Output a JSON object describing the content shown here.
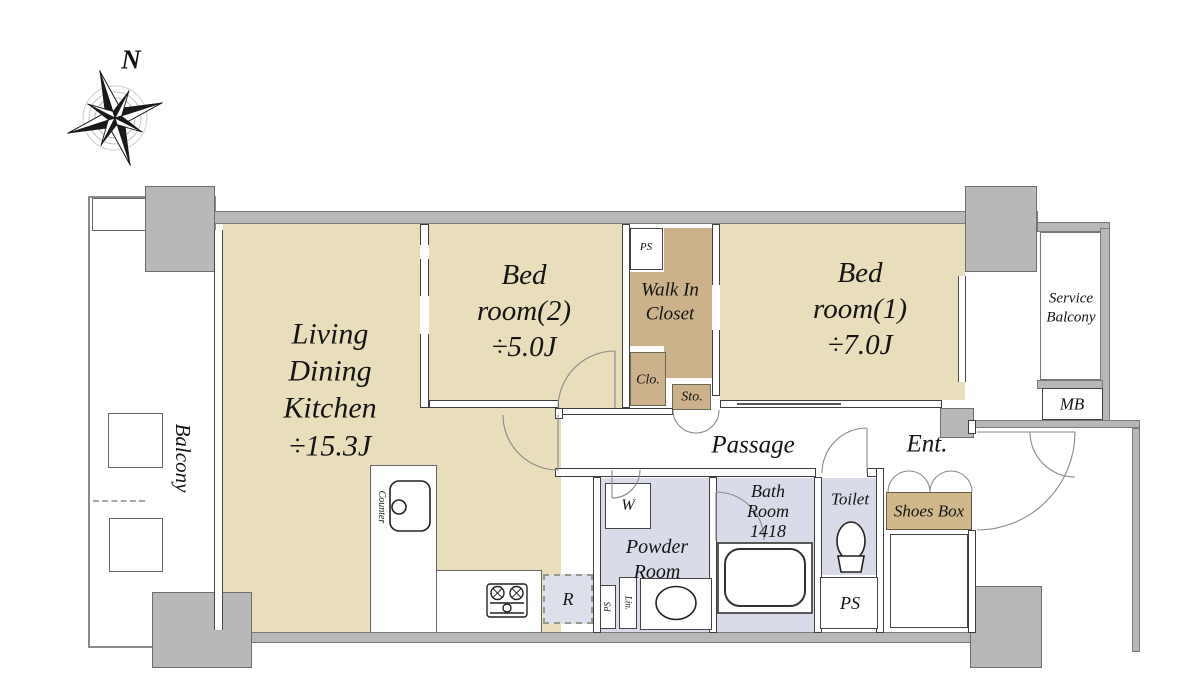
{
  "compass": {
    "north_label": "N"
  },
  "palette": {
    "room_tan": "#e8debc",
    "closet_tan": "#cbb28b",
    "shoes_tan": "#d0b88d",
    "wet_blue": "#d9dce8",
    "wall_gray": "#b8b8b8"
  },
  "rooms": {
    "balcony": {
      "label": "Balcony"
    },
    "ldk": {
      "label": "Living\nDining\nKitchen\n÷15.3J"
    },
    "bedroom2": {
      "label": "Bed\nroom(2)\n÷5.0J"
    },
    "bedroom1": {
      "label": "Bed\nroom(1)\n÷7.0J"
    },
    "walk_in_closet": {
      "label": "Walk In\nCloset"
    },
    "ps_upper": {
      "label": "PS"
    },
    "closet": {
      "label": "Clo."
    },
    "storage": {
      "label": "Sto."
    },
    "service_balcony": {
      "label": "Service\nBalcony"
    },
    "meter_box": {
      "label": "MB"
    },
    "passage": {
      "label": "Passage"
    },
    "entrance": {
      "label": "Ent."
    },
    "powder_room": {
      "label": "Powder\nRoom"
    },
    "washer": {
      "label": "W"
    },
    "bathroom": {
      "label": "Bath\nRoom\n1418"
    },
    "toilet": {
      "label": "Toilet"
    },
    "shoes_box": {
      "label": "Shoes Box"
    },
    "ps_lower": {
      "label": "PS"
    },
    "refrigerator": {
      "label": "R"
    },
    "ps_narrow": {
      "label": "PS"
    },
    "linen": {
      "label": "Lin."
    },
    "counter": {
      "label": "Counter"
    }
  }
}
